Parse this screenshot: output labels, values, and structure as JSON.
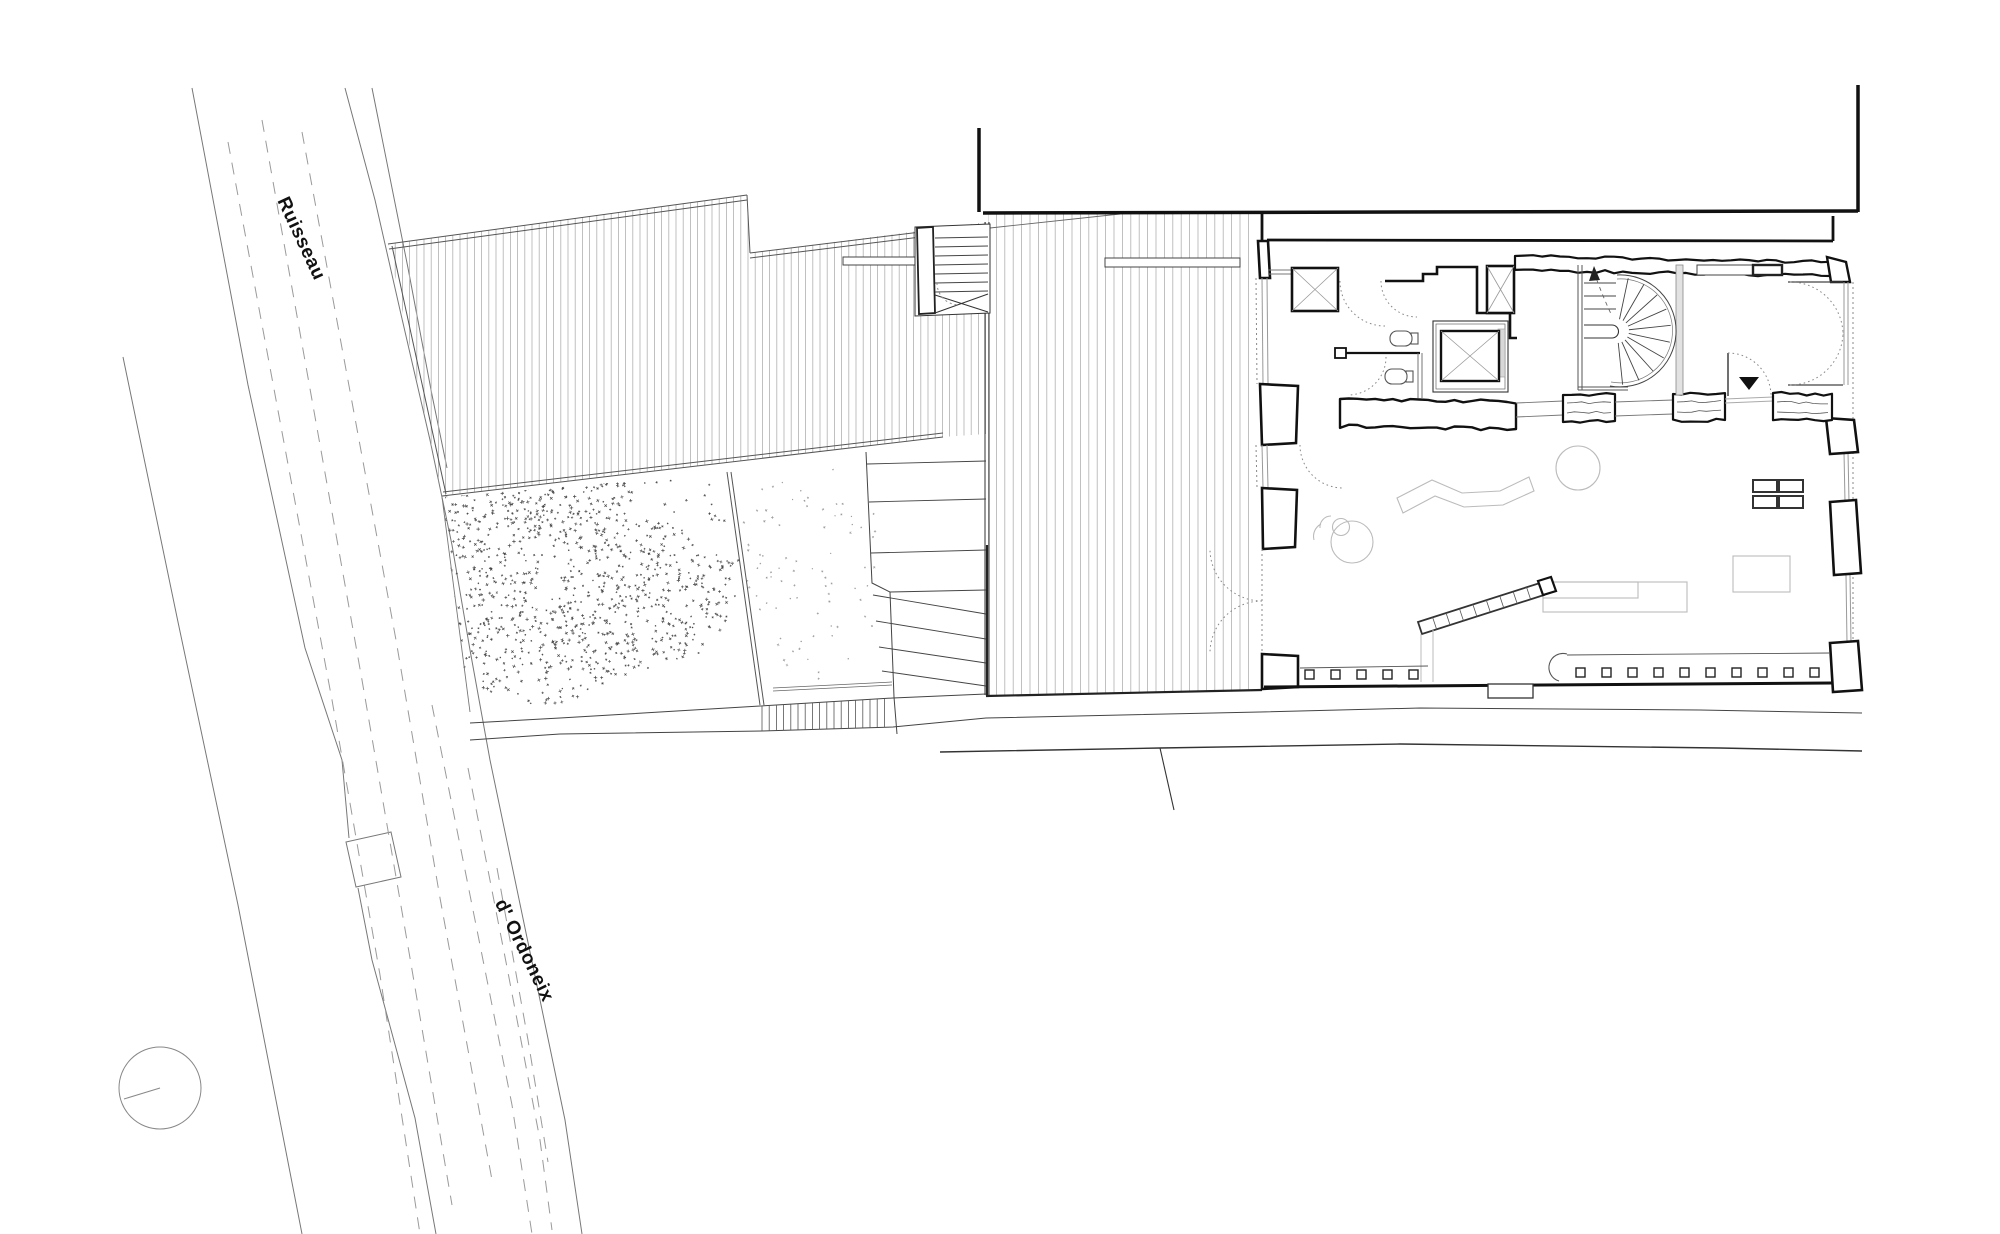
{
  "page": {
    "background": "#ffffff"
  },
  "labels": {
    "stream_name_upper": "Ruisseau",
    "stream_name_lower": "d' Ordoneix"
  },
  "colors": {
    "ink": "#1a1a1a",
    "wall": "#111111",
    "line_mid": "#555555",
    "line_light": "#aaaaaa",
    "dotted": "#888888",
    "furniture": "#bbbbbb",
    "hatch": "#b0b0b0",
    "stipple": "#4a4a4a"
  },
  "north_indicator": {
    "icon": "north-circle-icon"
  }
}
